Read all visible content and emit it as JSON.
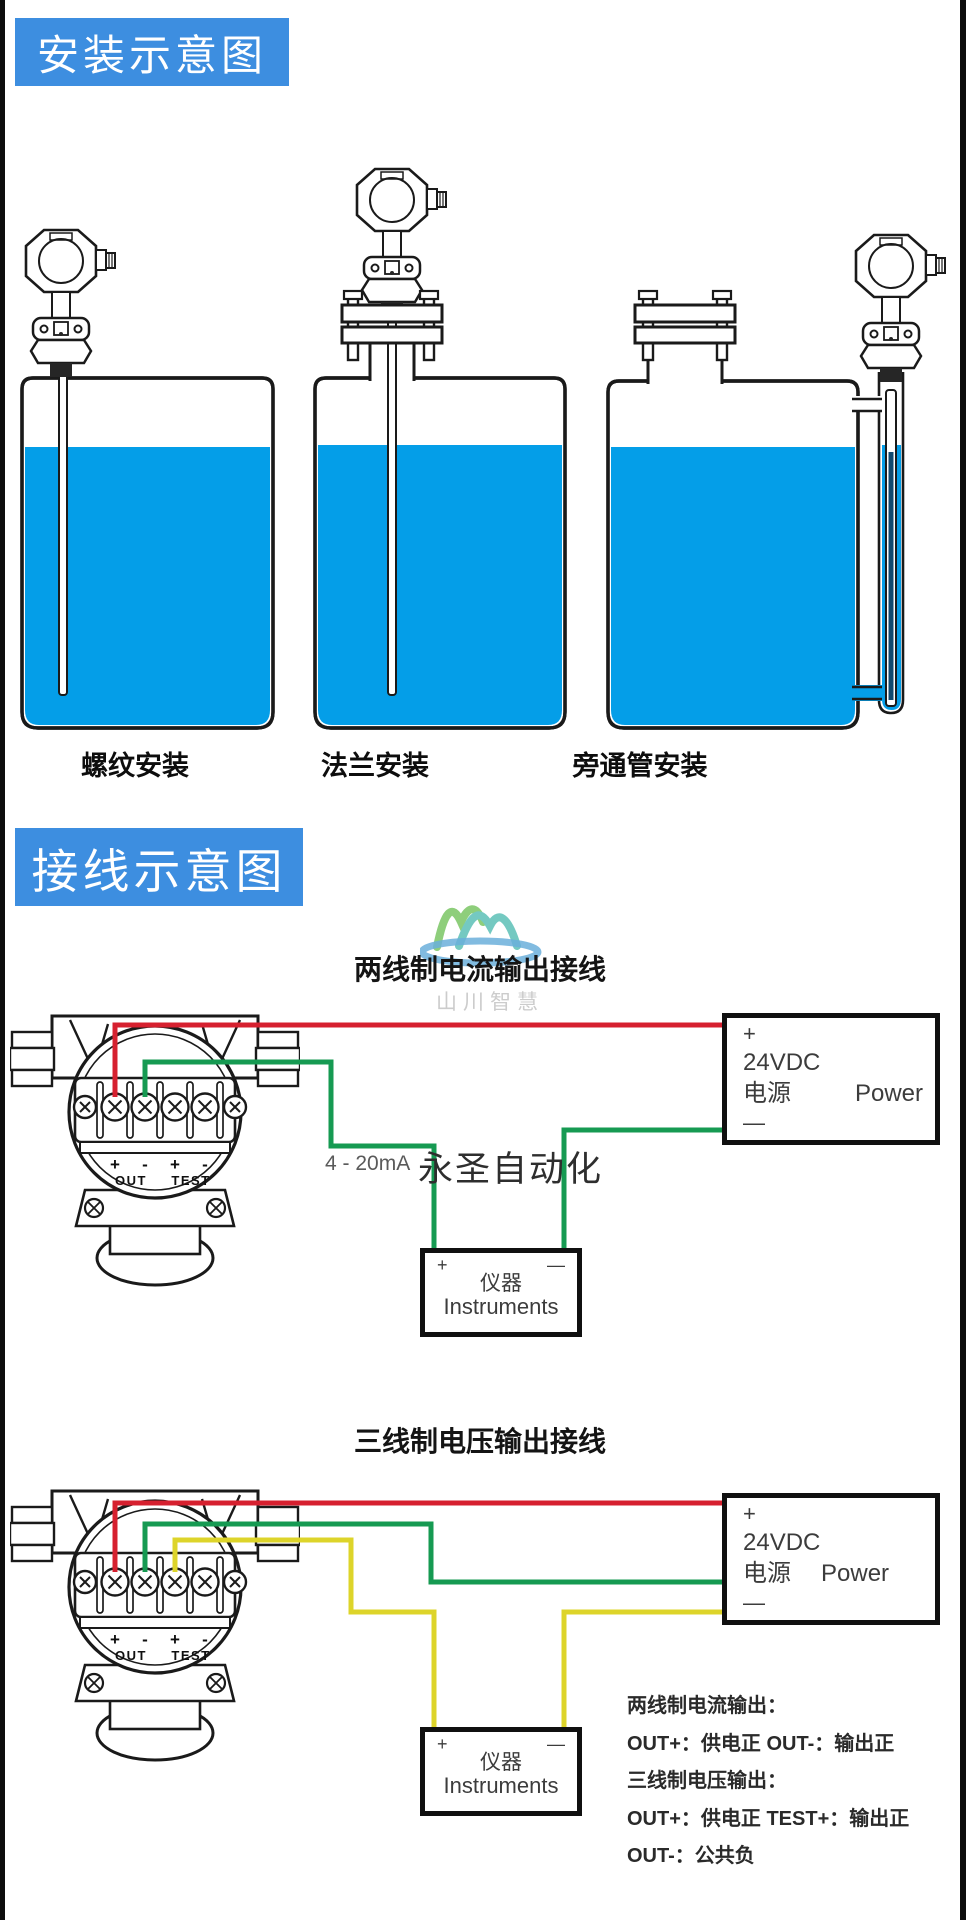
{
  "colors": {
    "title_bg": "#3d8ee0",
    "water": "#049ee8",
    "wire_red": "#d6202f",
    "wire_green": "#169a52",
    "wire_yellow": "#ddd42a"
  },
  "installation": {
    "title": "安装示意图",
    "methods": [
      {
        "label": "螺纹安装"
      },
      {
        "label": "法兰安装"
      },
      {
        "label": "旁通管安装"
      }
    ]
  },
  "wiring": {
    "title": "接线示意图",
    "watermark": {
      "logo_text": "山川智慧",
      "brand_text": "永圣自动化"
    },
    "terminal_labels": {
      "plus": "+",
      "minus": "-",
      "out": "OUT",
      "test": "TEST"
    },
    "diagrams": [
      {
        "heading": "两线制电流输出接线",
        "signal_label": "4 - 20mA",
        "power_box": {
          "plus": "+",
          "voltage": "24VDC",
          "label_cn": "电源",
          "label_en": "Power",
          "minus": "—"
        },
        "instrument_box": {
          "plus": "+",
          "minus": "—",
          "label_cn": "仪器",
          "label_en": "Instruments"
        }
      },
      {
        "heading": "三线制电压输出接线",
        "power_box": {
          "plus": "+",
          "voltage": "24VDC",
          "label_cn": "电源",
          "label_en": "Power",
          "minus": "—"
        },
        "instrument_box": {
          "plus": "+",
          "minus": "—",
          "label_cn": "仪器",
          "label_en": "Instruments"
        }
      }
    ],
    "notes": [
      "两线制电流输出：",
      "OUT+：供电正  OUT-：输出正",
      "三线制电压输出：",
      "OUT+：供电正 TEST+：输出正",
      "OUT-：公共负"
    ]
  }
}
